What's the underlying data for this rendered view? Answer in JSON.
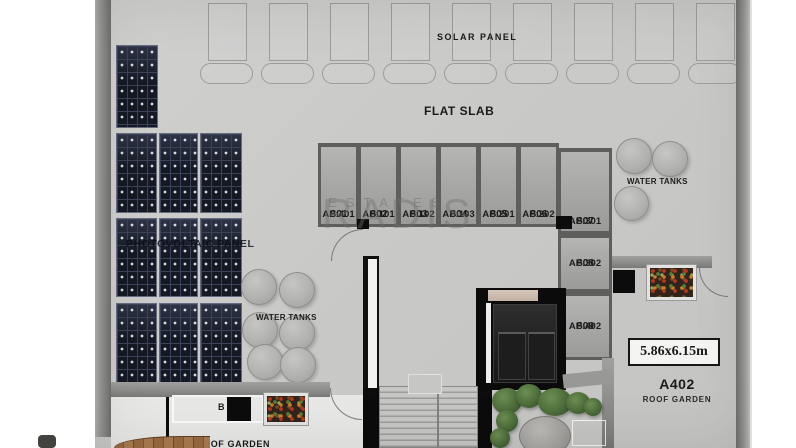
{
  "plan": {
    "solar_panel_label": "SOLAR PANEL",
    "flat_slab_label": "FLAT SLAB",
    "photovoltaic_label": "PHOTOVOLTAIC PANEL",
    "water_tanks_left_label": "WATER TANKS",
    "water_tanks_right_label": "WATER TANKS",
    "bbq_label": "B",
    "roof_garden_lower_label": "ROOF GARDEN",
    "dimension_label": "5.86x6.15m",
    "unit_code": "A402",
    "unit_name": "ROOF GARDEN"
  },
  "storage_units": [
    {
      "id": "S01",
      "ap": "AP:401"
    },
    {
      "id": "S02",
      "ap": "AP:101"
    },
    {
      "id": "S03",
      "ap": "AP:102"
    },
    {
      "id": "S04",
      "ap": "AP:103"
    },
    {
      "id": "S05",
      "ap": "AP:201"
    },
    {
      "id": "S06",
      "ap": "AP:202"
    },
    {
      "id": "S07",
      "ap": "AP:301"
    },
    {
      "id": "S08",
      "ap": "AP:302"
    },
    {
      "id": "S09",
      "ap": "AP:402"
    }
  ],
  "watermark": {
    "line1": "RADIS",
    "line2": "ESTATES"
  },
  "colors": {
    "concrete": "#cbcbc9",
    "wall": "#8a8a88",
    "pv_panel": "#151924",
    "accent_black": "#0c0c0c",
    "lower_garden": "#e8e8e6",
    "wood_deck": "#9a6a42",
    "plant_green": "#4c6b3a"
  }
}
